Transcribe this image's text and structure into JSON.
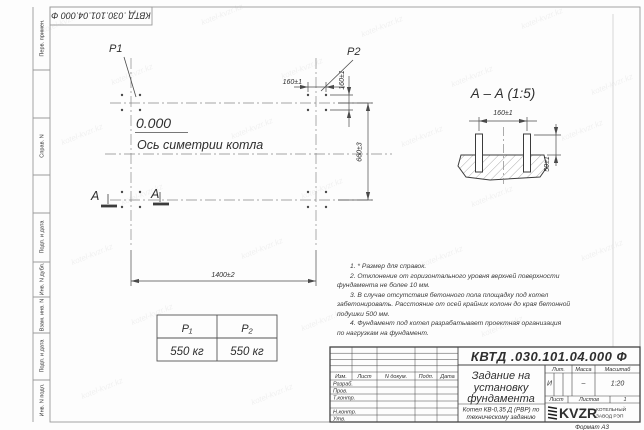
{
  "colors": {
    "ink": "#2f2f2f",
    "frame": "#9a9a9a"
  },
  "watermark": {
    "text": "kotel-kvzr.kz"
  },
  "stamp_top": {
    "doc_number": "КВТД .030.101.04.000  Ф"
  },
  "margin_labels": {
    "perv": "Перв. примен.",
    "sprav": "Справ. N",
    "podp1": "Подп. и дата",
    "inv_dubl": "Инв. N дубл.",
    "vzam": "Взам. инв. N",
    "podp2": "Подп. и дата",
    "inv_podl": "Инв. N подл."
  },
  "plan": {
    "p1_label": "P1",
    "p2_label": "P2",
    "elevation": "0.000",
    "axis_label": "Ось симетрии котла",
    "dim_160_top": "160±1",
    "dim_160_right": "160±1",
    "dim_660": "660±3",
    "dim_1400": "1400±2",
    "section_letter": "А"
  },
  "section": {
    "title": "А – А (1:5)",
    "dim_160": "160±1",
    "dim_50": "50±1"
  },
  "load_table": {
    "col1_header": "P₁",
    "col2_header": "P₂",
    "col1_value": "550 кг",
    "col2_value": "550 кг"
  },
  "notes": {
    "lines": [
      "1. * Размер для справок.",
      "2. Отклонение от горизонтального уровня верхней поверхности",
      "фундамента не более 10 мм.",
      "3. В случае отсутствия бетонного пола площадку под котел",
      "забетонировать. Расстояние от осей крайних колонн до края бетонной",
      "подушки 500 мм.",
      "4. Фундамент под котел разрабатывает проектная организация",
      "по нагрузкам на фундамент."
    ]
  },
  "title_block": {
    "doc_number": "КВТД .030.101.04.000  Ф",
    "title_line1": "Задание на",
    "title_line2": "установку",
    "title_line3": "фундамента",
    "subtitle_line1": "Котел КВ-0,35 Д (РВР) по",
    "subtitle_line2": "техническому заданию",
    "header_izm": "Изм.",
    "header_list": "Лист",
    "header_dokum": "N докум.",
    "header_podp": "Подп.",
    "header_data": "Дата",
    "row_razrab": "Разраб.",
    "row_prov": "Пров.",
    "row_tkontr": "Т.контр.",
    "row_nkontr": "Н.контр.",
    "row_utv": "Утв.",
    "lit_header": "Лит.",
    "massa_header": "Масса",
    "masshtab_header": "Масштаб",
    "lit_value": "И",
    "massa_value": "–",
    "masshtab_value": "1:20",
    "list_label": "Лист",
    "listov_label": "Листов",
    "listov_value": "1",
    "logo_text": "KVZR",
    "company_line1": "КОТЕЛЬНЫЙ",
    "company_line2": "ЗАВОД РЭП",
    "format_label": "Формат А3"
  }
}
